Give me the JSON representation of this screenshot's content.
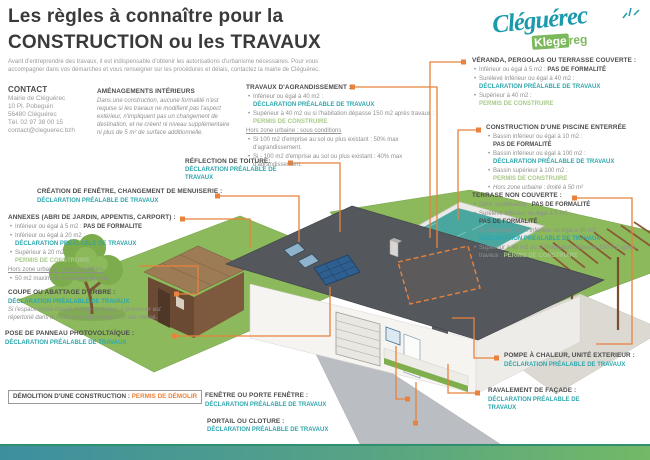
{
  "colors": {
    "teal": "#2fa7ad",
    "green": "#a9c98b",
    "orange": "#e8823c",
    "logo_teal": "#1a9aab",
    "logo_green": "#7cb85c",
    "heading_dark": "#4b4b4b"
  },
  "header": {
    "title_line1": "Les règles à connaître pour la",
    "title_line2": "CONSTRUCTION ou les TRAVAUX",
    "intro": "Avant d'entreprendre des travaux, il est indispensable d'obtenir les autorisations d'urbanisme nécessaires. Pour vous accompagner dans vos démarches et vous renseigner sur les procédures et délais, contactez la mairie de Cléguérec."
  },
  "logo": {
    "name": "Cléguérec",
    "sub_strong": "Klege",
    "sub_rest": "reg"
  },
  "contact": {
    "heading": "CONTACT",
    "lines": [
      "Mairie de Cléguérec",
      "10 Pl. Pobeguin",
      "56480 Cléguérec",
      "Tél. 02 97 38 00 15",
      "contact@cleguerec.bzh"
    ]
  },
  "sections": {
    "amenagements": {
      "heading": "AMÉNAGEMENTS INTÉRIEURS",
      "body": "Dans une construction, aucune formalité n'est requise si les travaux ne modifient pas l'aspect extérieur, n'impliquent pas un changement de destination, et ne créent ni niveau supplémentaire ni plus de 5 m² de surface additionnelle."
    },
    "agrandissement": {
      "heading": "TRAVAUX D'AGRANDISSEMENT :",
      "items": [
        {
          "pre": "Inférieur ou égal à 40 m2 :",
          "tag": "DÉCLARATION PRÉALABLE DE TRAVAUX"
        },
        {
          "pre": "Supérieur à 40 m2 ou si l'habitation dépasse 150 m2 après travaux :",
          "tag": "PERMIS DE CONSTRUIRE"
        }
      ],
      "note": "Hors zone urbaine : sous conditions",
      "subitems": [
        "Si 100 m2 d'emprise au sol ou plus existant : 50% max d'agrandissement.",
        "Si - 100 m2 d'emprise au sol ou plus existant : 40% max d'agrandissement."
      ]
    },
    "veranda": {
      "heading": "VÉRANDA, PERGOLAS OU TERRASSE COUVERTE :",
      "items": [
        {
          "pre": "Inférieur ou égal à 5 m2 :",
          "tag": "PAS DE FORMALITÉ"
        },
        {
          "pre": "Surélevé Inférieur ou égal à 40 m2 :",
          "tag": "DÉCLARATION PRÉALABLE DE TRAVAUX"
        },
        {
          "pre": "Supérieur à 40 m2 :",
          "tag": "PERMIS DE CONSTRUIRE"
        }
      ]
    },
    "piscine": {
      "heading": "CONSTRUCTION D'UNE PISCINE ENTERRÉE",
      "items": [
        {
          "pre": "Bassin inférieur ou égal à 10 m2 :",
          "tag": "PAS DE FORMALITÉ"
        },
        {
          "pre": "Bassin inférieur ou égal à 100 m2 :",
          "tag": "DÉCLARATION PRÉALABLE DE TRAVAUX"
        },
        {
          "pre": "Bassin supérieur à 100 m2 :",
          "tag": "PERMIS DE CONSTRUIRE"
        }
      ],
      "note": "Hors zone urbaine : limité à 50 m²"
    },
    "terrasse": {
      "heading": "TERRASE NON COUVERTE :",
      "items": [
        {
          "pre": "Sans surélévation :",
          "tag": "PAS DE FORMALITÉ"
        },
        {
          "pre": "Surélevé Inférieur ou égal à 5 m2 :",
          "tag": "PAS DE FORMALITÉ"
        },
        {
          "pre": "Surélevé de 0,5 m Inférieur ou égal à 40 m2 :",
          "tag": "DÉCLARATION PRÉALABLE DE TRAVAUX"
        },
        {
          "pre": "Supérieur à 40 m2 ou si l'habitation dépasse 150 m2 après travaux :",
          "tag": "PERMIS DE CONSTRUIRE"
        }
      ]
    },
    "refection": {
      "heading": "RÉFLECTION DE TOITURE:",
      "tag": "DÉCLARATION PRÉALABLE DE TRAVAUX"
    },
    "creation_fenetre": {
      "heading": "CRÉATION DE FENÊTRE, CHANGEMENT DE MENUISERIE :",
      "tag": "DÉCLARATION PRÉALABLE DE TRAVAUX"
    },
    "annexes": {
      "heading": "ANNEXES (ABRI DE JARDIN, APPENTIS, CARPORT) :",
      "items": [
        {
          "pre": "Inférieur ou égal à 5 m2 :",
          "tag": "PAS DE FORMALITE"
        },
        {
          "pre": "Inférieur ou égal à 20 m2 :",
          "tag": "DÉCLARATION PRÉALABLE DE TRAVAUX"
        },
        {
          "pre": "Supérieur à 20 m2 :",
          "tag": "PERMIS DE CONSTRUIRE"
        }
      ],
      "note": "Hors zone urbaine : sous conditions",
      "subitems": [
        "50 m2 maximum d'annexes (quota)"
      ]
    },
    "coupe": {
      "heading": "COUPE OU ABATTAGE D'ARBRE :",
      "tag": "DÉCLARATION PRÉALABLE DE TRAVAUX",
      "note": "Si l'espace boisé classé, l'arbre ou le taux à préserver est répertorié dans le PLU ou se trouve dans un site classé."
    },
    "panneau": {
      "heading": "POSE DE PANNEAU PHOTOVOLTAÏQUE :",
      "tag": "DÉCLARATION PRÉALABLE DE TRAVAUX"
    },
    "demolition": {
      "heading": "DÉMOLITION D'UNE CONSTRUCTION :",
      "tag": "PERMIS DE DÉMOLIR"
    },
    "fenetre": {
      "heading": "FENÊTRE OU PORTE FENÊTRE :",
      "tag": "DÉCLARATION PRÉALABLE DE TRAVAUX"
    },
    "portail": {
      "heading": "PORTAIL OU CLOTURE :",
      "tag": "DÉCLARATION PRÉALABLE DE TRAVAUX"
    },
    "pompe": {
      "heading": "POMPE À CHALEUR, UNITÉ EXTERIEUR :",
      "tag": "DÉCLARATION PRÉALABLE DE TRAVAUX"
    },
    "ravalement": {
      "heading": "RAVALEMENT DE FAÇADE :",
      "tag": "DÉCLARATION PRÉALABLE DE TRAVAUX"
    }
  }
}
